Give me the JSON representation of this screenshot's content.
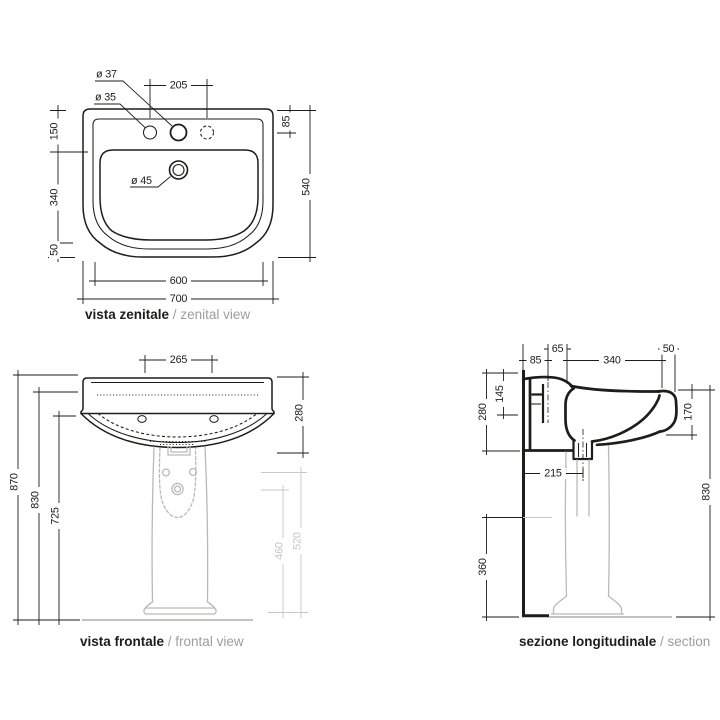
{
  "page": {
    "background": "#ffffff"
  },
  "colors": {
    "line": "#1d1d1b",
    "grey_line": "#b9b9b8",
    "grey_dim": "#c7c7c6",
    "caption_sub": "#9d9d9c"
  },
  "views": {
    "zenital": {
      "caption_it": "vista zenitale",
      "caption_sep": " / ",
      "caption_en": "zenital view",
      "dims": {
        "tap_hole_center": "ø 37",
        "tap_hole_side": "ø 35",
        "drain": "ø 45",
        "tap_spacing": "205",
        "back_offset": "85",
        "back_depth": "150",
        "bowl_depth": "340",
        "front_edge": "50",
        "total_depth": "540",
        "inner_width": "600",
        "total_width": "700"
      }
    },
    "frontal": {
      "caption_it": "vista frontale",
      "caption_sep": " / ",
      "caption_en": "frontal view",
      "dims": {
        "tap_spacing": "265",
        "basin_height": "280",
        "total_height": "870",
        "rim_height": "830",
        "underside_height": "725",
        "pedestal_inner_height": "460",
        "pedestal_outer_height": "520"
      }
    },
    "section": {
      "caption_it": "sezione longitudinale",
      "caption_sep": " / ",
      "caption_en": "section",
      "dims": {
        "wall_offset": "85",
        "bolt_offset": "65",
        "bowl_length": "340",
        "front_edge": "50",
        "deck_drop": "145",
        "basin_depth": "280",
        "drain_offset": "215",
        "apron_height": "170",
        "rim_height": "830",
        "trap_height": "360"
      }
    }
  }
}
